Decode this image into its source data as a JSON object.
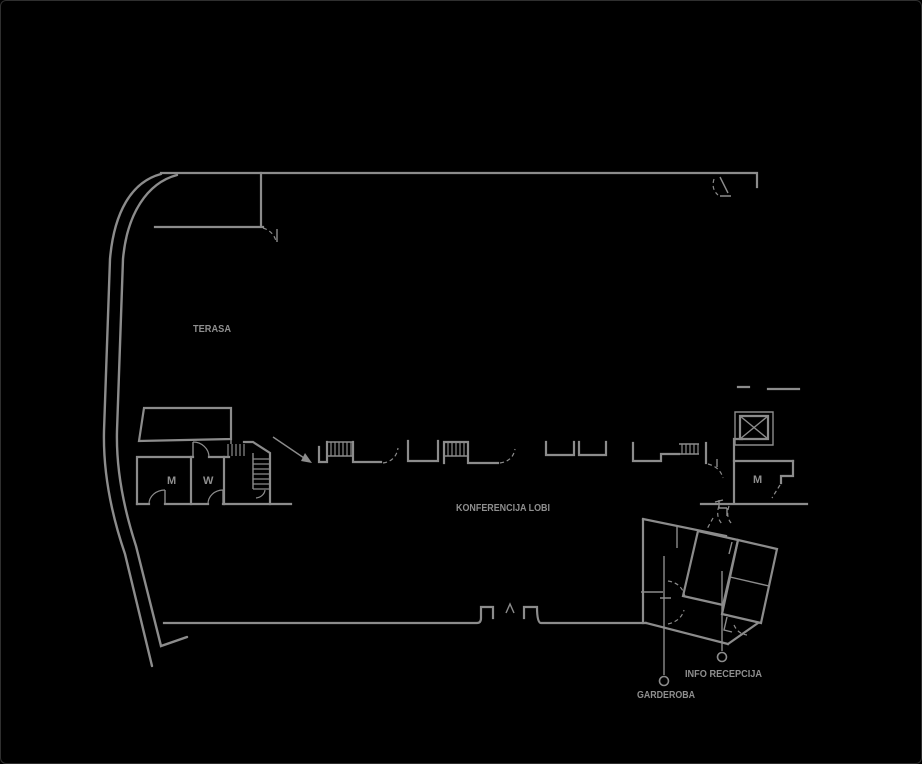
{
  "page": {
    "background_color": "#000000",
    "frame_border_color": "#2f2f2f",
    "line_color": "#8c8c8c",
    "text_color": "#8f8f8f"
  },
  "floorplan": {
    "labels": {
      "terasa": "TERASA",
      "konferencija_lobi": "KONFERENCIJA LOBI",
      "toilet_m_left": "M",
      "toilet_w": "W",
      "toilet_m_right": "M",
      "info_recepcija": "INFO RECEPCIJA",
      "garderoba": "GARDEROBA"
    },
    "icons": {
      "elevator": "crossed-box-elevator-symbol"
    }
  }
}
